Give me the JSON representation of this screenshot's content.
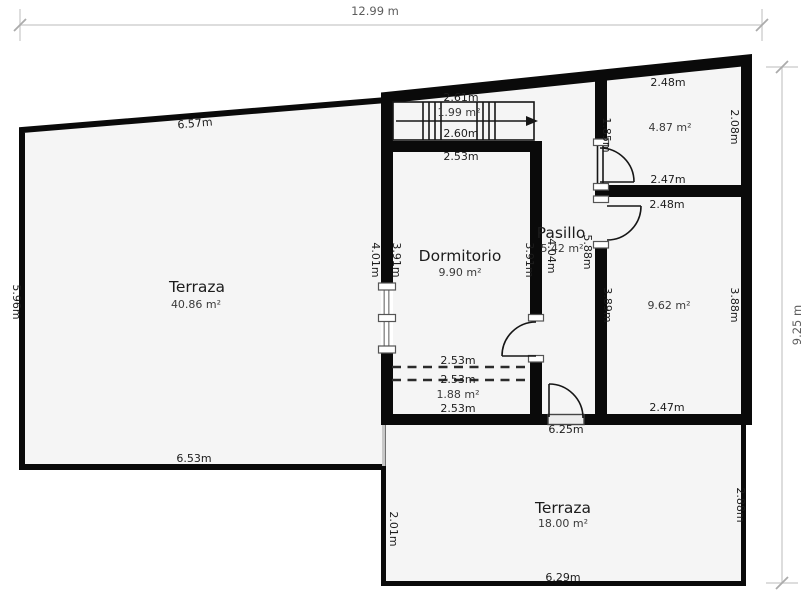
{
  "plan_type": "floor-plan",
  "overall_dimensions": {
    "width": "12.99 m",
    "height": "9.25 m"
  },
  "colors": {
    "wall": "#0a0a0a",
    "floor": "#f5f5f5",
    "background": "#ffffff",
    "dimension_line": "#d2d2d2"
  },
  "rooms": {
    "terraza_left": {
      "name": "Terraza",
      "area": "40.86 m²",
      "dim_top": "6.57m",
      "dim_left": "5.96m",
      "dim_bottom": "6.53m"
    },
    "stairs": {
      "area": "1.99 m²",
      "dim_top": "2.61m",
      "dim_bottom": "2.60m"
    },
    "dormitorio": {
      "name": "Dormitorio",
      "area": "9.90 m²",
      "dim_top": "2.53m",
      "dim_left_outside": "4.01m",
      "dim_left_inside": "3.91m",
      "dim_right_inside": "3.91m"
    },
    "pasillo": {
      "name": "Pasillo",
      "area": "5.42 m²",
      "dim_left": "4.04m",
      "dim_right": "5.88m",
      "dim_door_top": "1.85m"
    },
    "room_top_right": {
      "area": "4.87 m²",
      "dim_top": "2.48m",
      "dim_right": "2.08m",
      "dim_bottom": "2.47m"
    },
    "room_mid_right": {
      "area": "9.62 m²",
      "dim_top": "2.48m",
      "dim_left": "3.89m",
      "dim_right": "3.88m",
      "dim_bottom": "2.47m"
    },
    "closet": {
      "area": "1.88 m²",
      "dim_top_upper": "2.53m",
      "dim_top_lower": "2.53m",
      "dim_bottom": "2.53m"
    },
    "terraza_bottom": {
      "name": "Terraza",
      "area": "18.00 m²",
      "dim_opening": "6.25m",
      "dim_left": "2.01m",
      "dim_right": "2.88m",
      "dim_bottom": "6.29m"
    }
  }
}
